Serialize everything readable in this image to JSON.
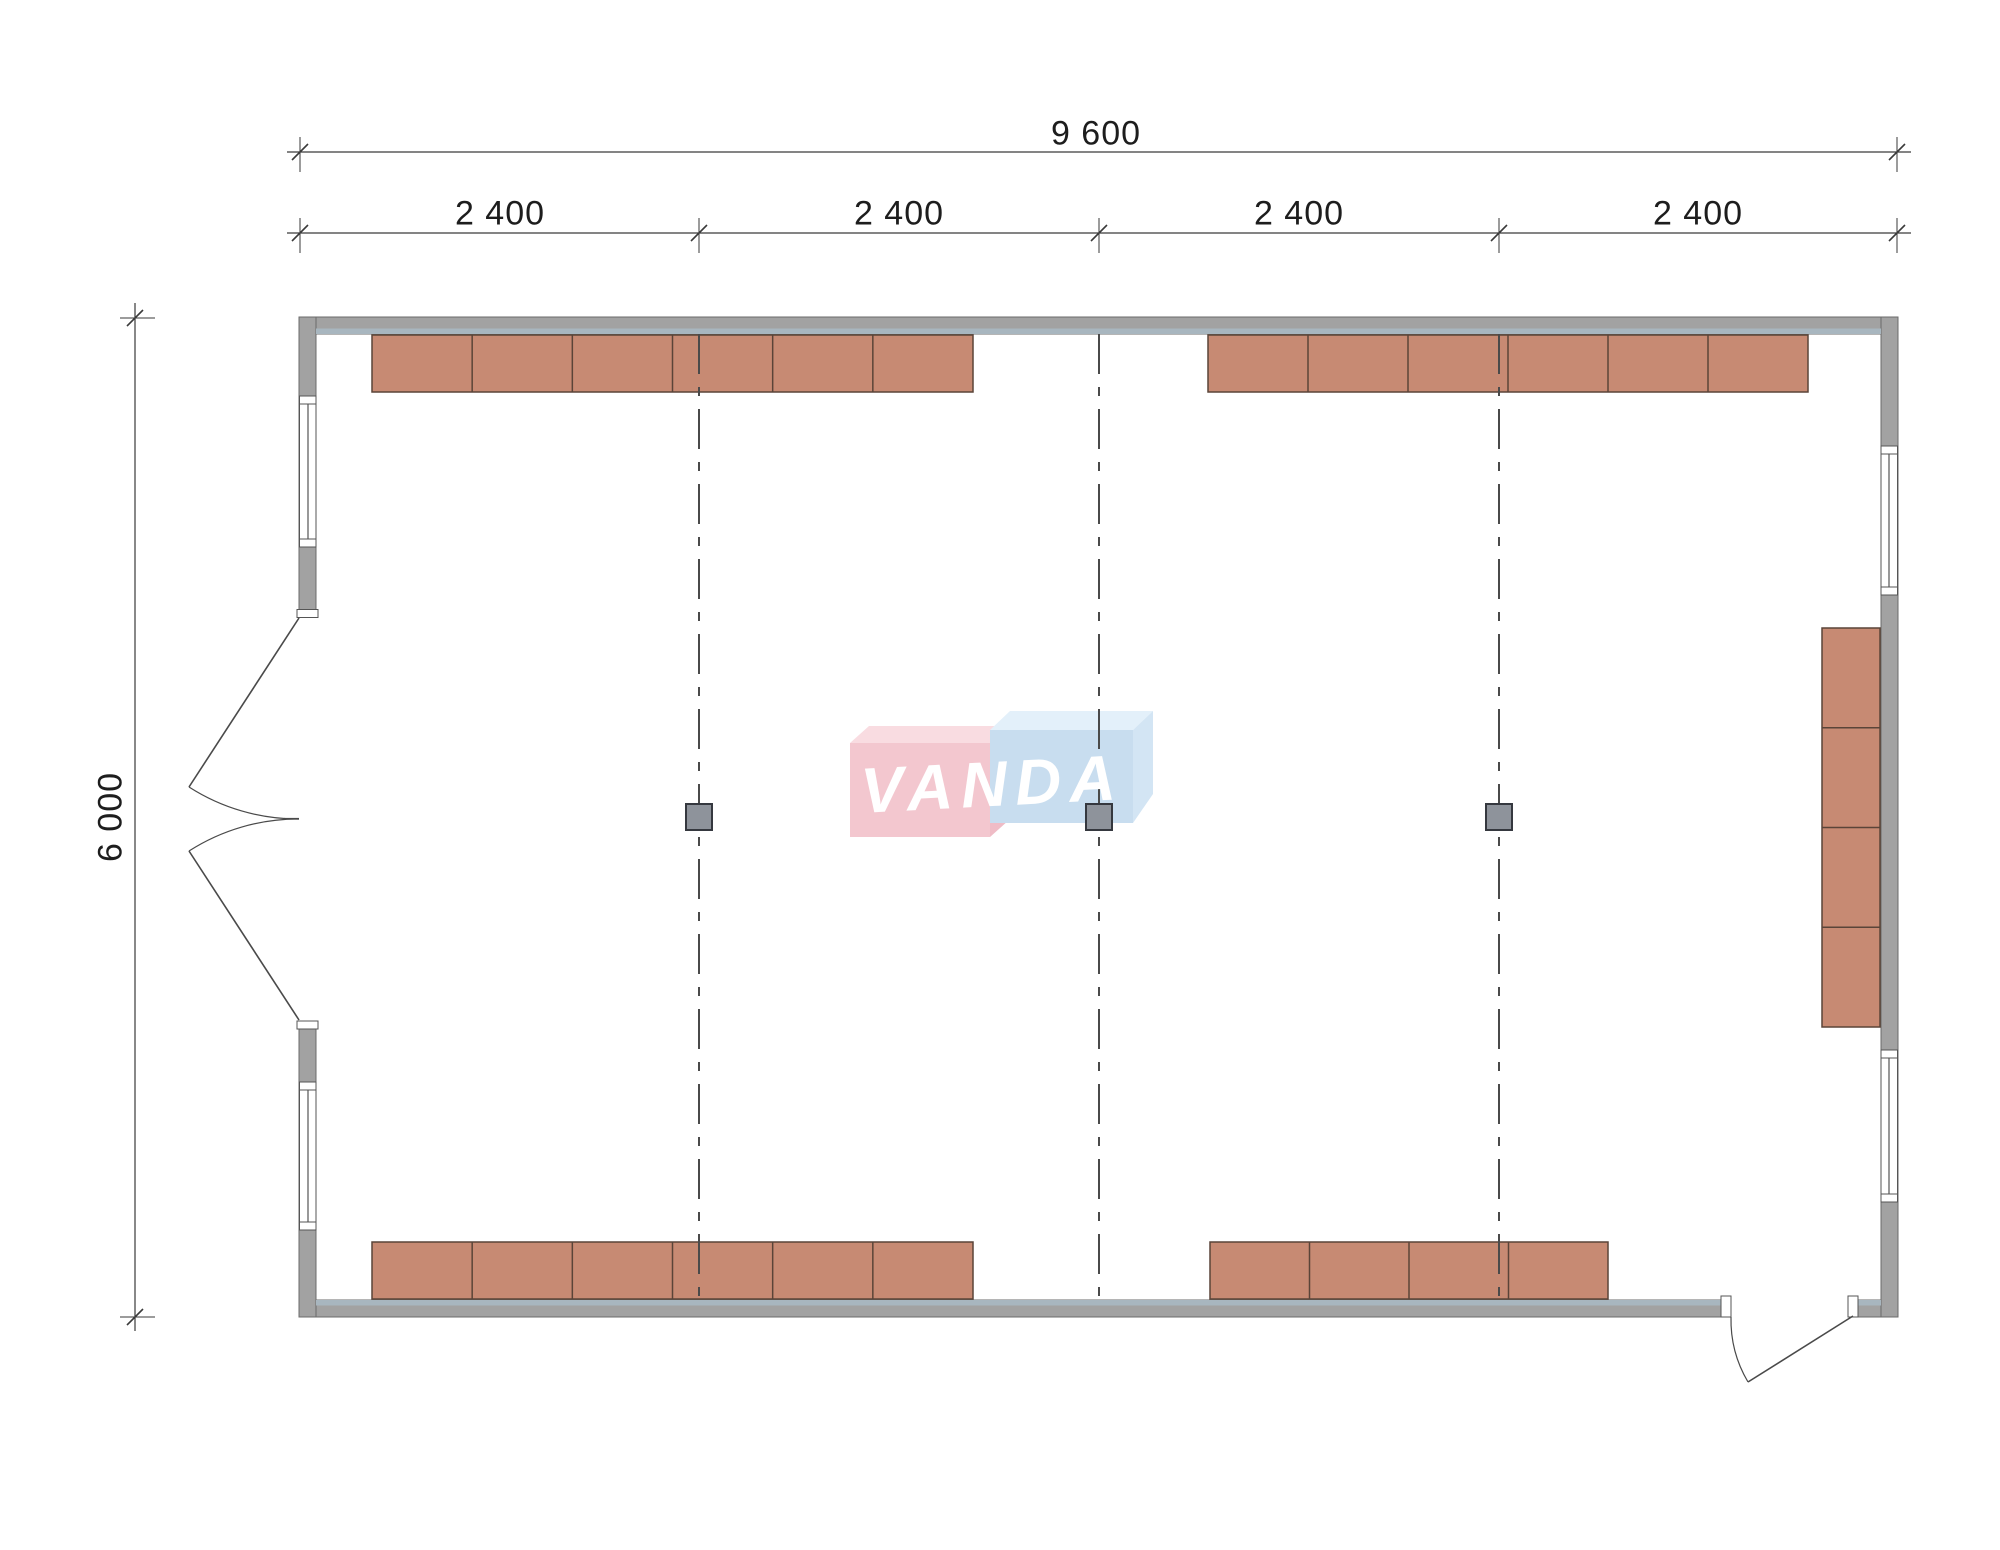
{
  "page": {
    "background": "#ffffff"
  },
  "colors": {
    "wall": "#a2a2a2",
    "wall_stroke": "#6b6b6b",
    "liner": "#a8b6bf",
    "furniture": "#c78a73",
    "furniture_stroke": "#5a4438",
    "column": "#8e939b",
    "column_stroke": "#35383f",
    "grid": "#4a4a4a",
    "door": "#4a4a4a",
    "dim": "#3a3a3a",
    "window_fill": "#ffffff",
    "window_stroke": "#555555",
    "logo_pink_front": "#f3c7cf",
    "logo_pink_top": "#f9dce1",
    "logo_pink_side": "#efbcc6",
    "logo_blue_front": "#c8ddef",
    "logo_blue_top": "#e3f0fa",
    "logo_blue_side": "#d3e5f4",
    "logo_text_color": "#ffffff"
  },
  "labels": {
    "total_width": "9 600",
    "bays": [
      "2 400",
      "2 400",
      "2 400",
      "2 400"
    ],
    "total_height": "6 000"
  },
  "label_positions": {
    "total_width": {
      "x": 1096,
      "y": 134
    },
    "bays": [
      {
        "x": 500,
        "y": 214
      },
      {
        "x": 899,
        "y": 214
      },
      {
        "x": 1299,
        "y": 214
      },
      {
        "x": 1698,
        "y": 214
      }
    ],
    "total_height": {
      "x": 111,
      "y": 817
    }
  },
  "logo": {
    "text": "VANDA",
    "x": 992,
    "y": 784,
    "rotate": -3,
    "pink_front": {
      "x": 850,
      "y": 743,
      "w": 140,
      "h": 94
    },
    "pink_top": "850,743 869,726 1009,726 990,743",
    "pink_side": "990,743 1009,726 1009,820 990,837",
    "blue_front": {
      "x": 990,
      "y": 730,
      "w": 143,
      "h": 93
    },
    "blue_top": "990,730 1010,711 1153,711 1133,730",
    "blue_side": "1133,730 1153,711 1153,794 1133,823"
  },
  "plan": {
    "walls": [
      {
        "x": 299,
        "y": 317,
        "w": 1599,
        "h": 17,
        "name": "top-wall"
      },
      {
        "x": 299,
        "y": 1300,
        "w": 1599,
        "h": 17,
        "name": "bottom-wall"
      },
      {
        "x": 299,
        "y": 317,
        "w": 17,
        "h": 1000,
        "name": "left-wall"
      },
      {
        "x": 1881,
        "y": 317,
        "w": 17,
        "h": 1000,
        "name": "right-wall"
      }
    ],
    "liners": [
      {
        "x": 316,
        "y": 328.5,
        "w": 1565,
        "h": 5.5,
        "name": "top-wall-inner-liner"
      },
      {
        "x": 316,
        "y": 1300,
        "w": 1565,
        "h": 5.5,
        "name": "bottom-wall-inner-liner"
      }
    ],
    "furniture": [
      {
        "x": 372,
        "y": 335,
        "w": 601,
        "h": 57,
        "cells": 6,
        "dir": "h",
        "name": "cabinet-row-top-left"
      },
      {
        "x": 1208,
        "y": 335,
        "w": 600,
        "h": 57,
        "cells": 6,
        "dir": "h",
        "name": "cabinet-row-top-right"
      },
      {
        "x": 372,
        "y": 1242,
        "w": 601,
        "h": 57,
        "cells": 6,
        "dir": "h",
        "name": "cabinet-row-bottom-left"
      },
      {
        "x": 1210,
        "y": 1242,
        "w": 398,
        "h": 57,
        "cells": 4,
        "dir": "h",
        "name": "cabinet-row-bottom-right"
      },
      {
        "x": 1822,
        "y": 628,
        "w": 58,
        "h": 399,
        "cells": 4,
        "dir": "v",
        "name": "cabinet-column-right-wall"
      }
    ],
    "windows": [
      {
        "frame": {
          "x": 299.5,
          "y": 396,
          "w": 16.5,
          "h": 151
        },
        "caps": [
          {
            "x": 299.5,
            "y": 396,
            "w": 16.5,
            "h": 8
          },
          {
            "x": 299.5,
            "y": 539,
            "w": 16.5,
            "h": 8
          }
        ],
        "glass": {
          "x1": 308,
          "y1": 404,
          "x2": 308,
          "y2": 539
        },
        "name": "window-left-top"
      },
      {
        "frame": {
          "x": 299.5,
          "y": 1082,
          "w": 16.5,
          "h": 148
        },
        "caps": [
          {
            "x": 299.5,
            "y": 1082,
            "w": 16.5,
            "h": 8
          },
          {
            "x": 299.5,
            "y": 1222,
            "w": 16.5,
            "h": 8
          }
        ],
        "glass": {
          "x1": 308,
          "y1": 1090,
          "x2": 308,
          "y2": 1222
        },
        "name": "window-left-bottom"
      },
      {
        "frame": {
          "x": 1881,
          "y": 446,
          "w": 16.5,
          "h": 149
        },
        "caps": [
          {
            "x": 1881,
            "y": 446,
            "w": 16.5,
            "h": 8
          },
          {
            "x": 1881,
            "y": 587,
            "w": 16.5,
            "h": 8
          }
        ],
        "glass": {
          "x1": 1889,
          "y1": 454,
          "x2": 1889,
          "y2": 587
        },
        "name": "window-right-top"
      },
      {
        "frame": {
          "x": 1881,
          "y": 1050,
          "w": 16.5,
          "h": 152
        },
        "caps": [
          {
            "x": 1881,
            "y": 1050,
            "w": 16.5,
            "h": 8
          },
          {
            "x": 1881,
            "y": 1194,
            "w": 16.5,
            "h": 8
          }
        ],
        "glass": {
          "x1": 1889,
          "y1": 1058,
          "x2": 1889,
          "y2": 1194
        },
        "name": "window-right-bottom"
      }
    ],
    "door_gaps": [
      {
        "x": 298.5,
        "y": 617,
        "w": 18,
        "h": 404,
        "name": "left-door-opening"
      },
      {
        "x": 1731,
        "y": 1299,
        "w": 117,
        "h": 19,
        "name": "bottom-door-opening"
      }
    ],
    "door_jambs": [
      {
        "x": 297,
        "y": 609.5,
        "w": 21,
        "h": 8
      },
      {
        "x": 297,
        "y": 1021,
        "w": 21,
        "h": 8
      },
      {
        "x": 1721,
        "y": 1296,
        "w": 10,
        "h": 21
      },
      {
        "x": 1848,
        "y": 1296,
        "w": 10,
        "h": 21
      }
    ],
    "door_paths": [
      {
        "d": "M 299 618 L 189 787",
        "w": 1.6,
        "name": "left-door-upper-leaf"
      },
      {
        "d": "M 299 819 A 202 202 0 0 1 189 787",
        "w": 1.2,
        "name": "left-door-upper-swing-arc"
      },
      {
        "d": "M 299 1020 L 189 851",
        "w": 1.6,
        "name": "left-door-lower-leaf"
      },
      {
        "d": "M 299 819 A 202 202 0 0 0 189 851",
        "w": 1.2,
        "name": "left-door-lower-swing-arc"
      },
      {
        "d": "M 284 818.5 L 299 818.5",
        "w": 1.2,
        "name": "left-door-meeting-line"
      },
      {
        "d": "M 1853 1316 L 1748 1382",
        "w": 1.6,
        "name": "bottom-door-leaf"
      },
      {
        "d": "M 1731 1317 A 122 122 0 0 0 1748 1382",
        "w": 1.2,
        "name": "bottom-door-swing-arc"
      }
    ],
    "grid": {
      "xs": [
        699,
        1099,
        1499
      ],
      "y1": 334,
      "y2": 1299,
      "dash": "40 13 9 13"
    },
    "columns": [
      {
        "x": 686,
        "y": 804,
        "s": 26
      },
      {
        "x": 1086,
        "y": 804,
        "s": 26
      },
      {
        "x": 1486,
        "y": 804,
        "s": 26
      }
    ],
    "dim_lines": [
      {
        "x1": 287,
        "y1": 152,
        "x2": 1911,
        "y2": 152,
        "name": "dim-line-total-width"
      },
      {
        "x1": 287,
        "y1": 233,
        "x2": 1911,
        "y2": 233,
        "name": "dim-line-bays"
      },
      {
        "x1": 135,
        "y1": 303,
        "x2": 135,
        "y2": 1331,
        "name": "dim-line-total-height"
      }
    ],
    "dim_ticks": [
      {
        "x": 300,
        "y": 152
      },
      {
        "x": 1897,
        "y": 152
      },
      {
        "x": 300,
        "y": 233
      },
      {
        "x": 699,
        "y": 233
      },
      {
        "x": 1099,
        "y": 233
      },
      {
        "x": 1499,
        "y": 233
      },
      {
        "x": 1897,
        "y": 233
      },
      {
        "x": 135,
        "y": 318
      },
      {
        "x": 135,
        "y": 1317
      }
    ],
    "dim_stubs": [
      {
        "x": 300,
        "y": 152,
        "o": "v"
      },
      {
        "x": 1897,
        "y": 152,
        "o": "v"
      },
      {
        "x": 300,
        "y": 233,
        "o": "v"
      },
      {
        "x": 699,
        "y": 233,
        "o": "v"
      },
      {
        "x": 1099,
        "y": 233,
        "o": "v"
      },
      {
        "x": 1499,
        "y": 233,
        "o": "v"
      },
      {
        "x": 1897,
        "y": 233,
        "o": "v"
      },
      {
        "x": 135,
        "y": 318,
        "o": "h"
      },
      {
        "x": 135,
        "y": 1317,
        "o": "h"
      }
    ]
  }
}
